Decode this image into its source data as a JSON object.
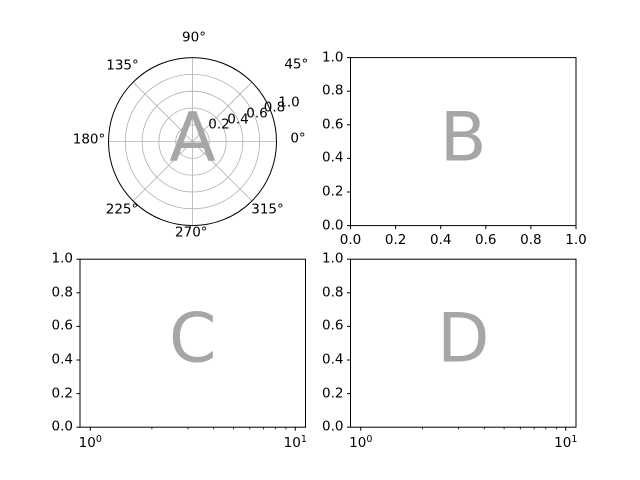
{
  "figure": {
    "colors": {
      "background": "#ffffff",
      "letter": "#a6a6a6",
      "grid": "#b0b0b0",
      "spine": "#000000",
      "tick_label": "#000000"
    }
  },
  "panels": {
    "a": {
      "letter": "A",
      "theta_labels": [
        "0°",
        "45°",
        "90°",
        "135°",
        "180°",
        "225°",
        "270°",
        "315°"
      ],
      "r_labels": [
        "0.2",
        "0.4",
        "0.6",
        "0.8",
        "1.0"
      ]
    },
    "b": {
      "letter": "B",
      "x_labels": [
        "0.0",
        "0.2",
        "0.4",
        "0.6",
        "0.8",
        "1.0"
      ],
      "y_labels": [
        "0.0",
        "0.2",
        "0.4",
        "0.6",
        "0.8",
        "1.0"
      ]
    },
    "c": {
      "letter": "C",
      "x_log_labels": [
        {
          "base": "10",
          "exp": "0"
        },
        {
          "base": "10",
          "exp": "1"
        }
      ],
      "y_labels": [
        "0.0",
        "0.2",
        "0.4",
        "0.6",
        "0.8",
        "1.0"
      ]
    },
    "d": {
      "letter": "D",
      "x_log_labels": [
        {
          "base": "10",
          "exp": "0"
        },
        {
          "base": "10",
          "exp": "1"
        }
      ],
      "y_labels": [
        "0.0",
        "0.2",
        "0.4",
        "0.6",
        "0.8",
        "1.0"
      ]
    }
  },
  "chart_data": [
    {
      "type": "polar",
      "annotation": "A",
      "theta_ticks_deg": [
        0,
        45,
        90,
        135,
        180,
        225,
        270,
        315
      ],
      "r_ticks": [
        0.2,
        0.4,
        0.6,
        0.8,
        1.0
      ],
      "r_range": [
        0,
        1
      ],
      "r_label_angle_deg": 22.5,
      "grid": true,
      "series": []
    },
    {
      "type": "line",
      "annotation": "B",
      "x_ticks": [
        0.0,
        0.2,
        0.4,
        0.6,
        0.8,
        1.0
      ],
      "y_ticks": [
        0.0,
        0.2,
        0.4,
        0.6,
        0.8,
        1.0
      ],
      "xlim": [
        0,
        1
      ],
      "ylim": [
        0,
        1
      ],
      "grid": false,
      "series": []
    },
    {
      "type": "line",
      "annotation": "C",
      "x_scale": "log",
      "x_major_ticks": [
        1,
        10
      ],
      "x_minor_ticks": [
        2,
        3,
        4,
        5,
        6,
        7,
        8,
        9
      ],
      "y_ticks": [
        0.0,
        0.2,
        0.4,
        0.6,
        0.8,
        1.0
      ],
      "ylim": [
        0,
        1
      ],
      "grid": false,
      "series": []
    },
    {
      "type": "line",
      "annotation": "D",
      "x_scale": "log",
      "x_major_ticks": [
        1,
        10
      ],
      "x_minor_ticks": [
        2,
        3,
        4,
        5,
        6,
        7,
        8,
        9
      ],
      "y_ticks": [
        0.0,
        0.2,
        0.4,
        0.6,
        0.8,
        1.0
      ],
      "ylim": [
        0,
        1
      ],
      "grid": false,
      "series": []
    }
  ]
}
